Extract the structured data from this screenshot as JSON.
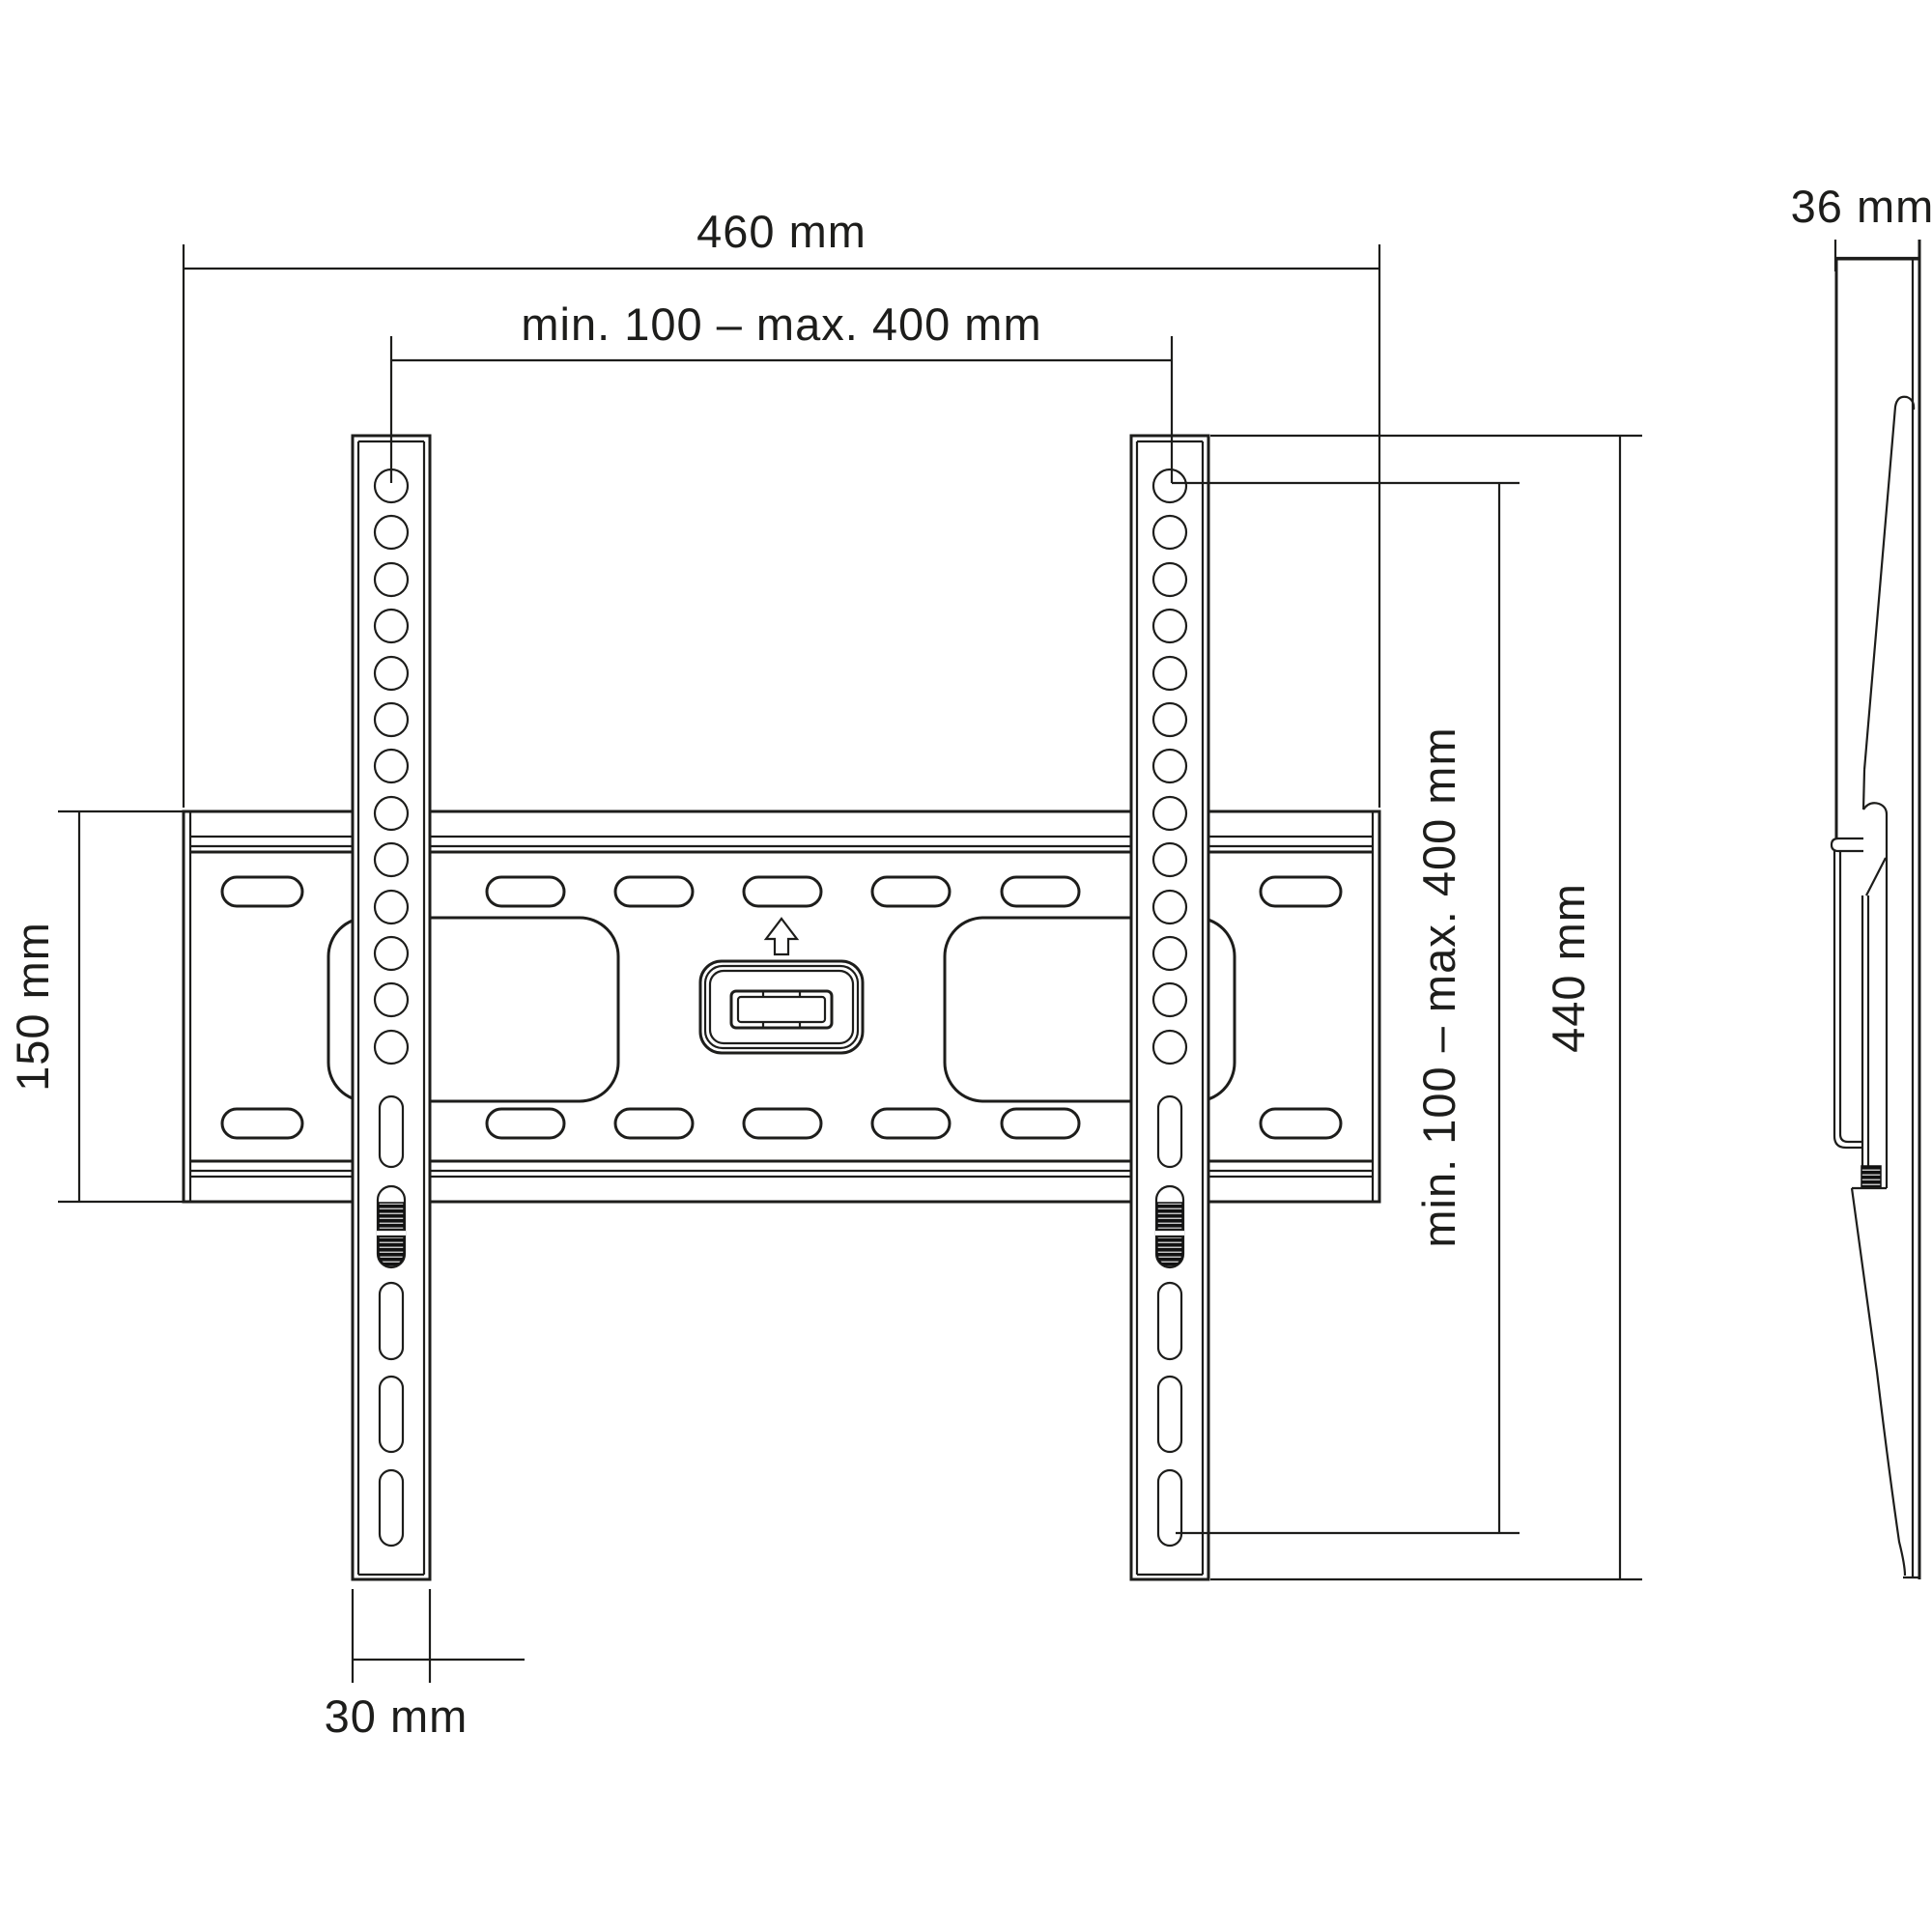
{
  "drawing": {
    "type": "technical-dimension-drawing",
    "subject": "fixed TV wall mount bracket, front view and side view",
    "colors": {
      "line": "#1d1d1b",
      "background": "#ffffff",
      "thread_fill": "#111111"
    },
    "views": {
      "front_view": "wall plate with two vertical VESA rails, mounting slots, locking screws and center lock tab with up arrow",
      "side_view": "profile of bracket on wall, depth dimension"
    },
    "dimensions": {
      "plate_width": "460 mm",
      "vesa_horizontal": "min. 100 – max. 400 mm",
      "depth": "36 mm",
      "plate_height": "150 mm",
      "vesa_vertical": "min. 100 – max. 400 mm",
      "rail_height": "440 mm",
      "rail_width": "30 mm"
    }
  }
}
